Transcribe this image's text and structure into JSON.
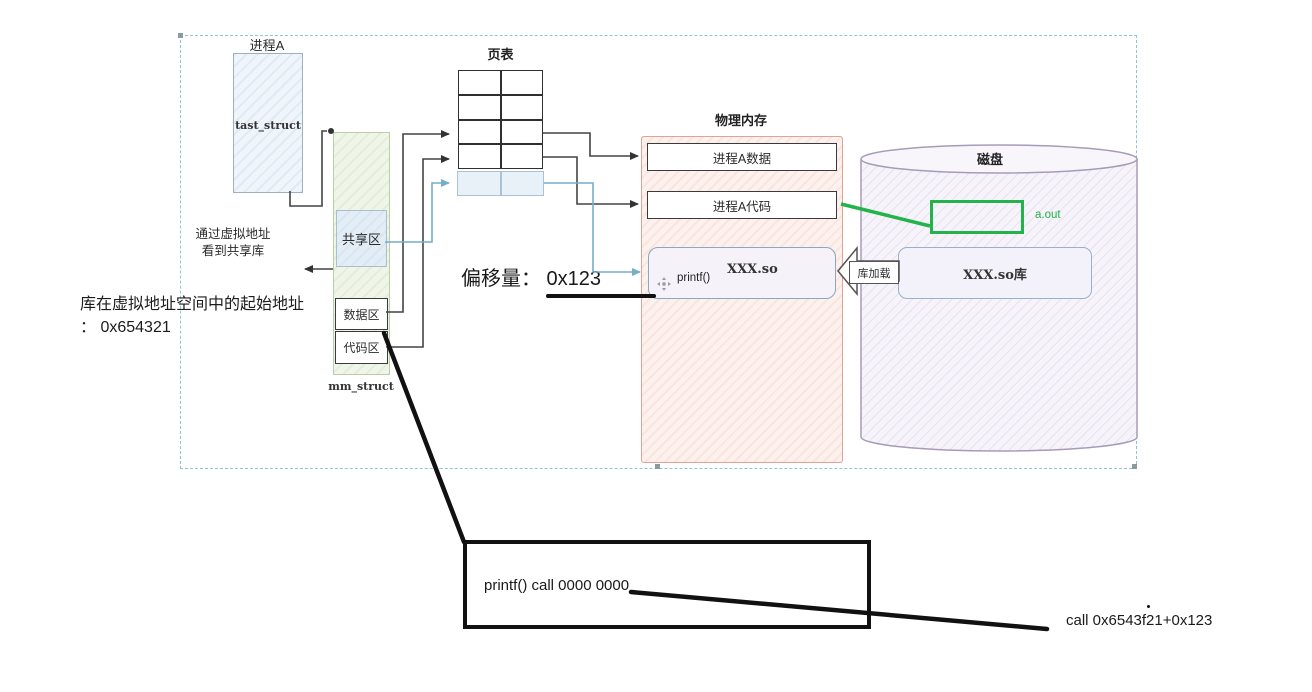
{
  "diagram": {
    "process_a": {
      "title": "进程A",
      "task_struct": "tast_struct"
    },
    "mm_struct": {
      "label": "mm_struct",
      "shared_region": "共享区",
      "data_region": "数据区",
      "code_region": "代码区"
    },
    "page_table": {
      "title": "页表"
    },
    "physical_memory": {
      "title": "物理内存",
      "proc_a_data": "进程A数据",
      "proc_a_code": "进程A代码",
      "so_box": {
        "func": "printf()",
        "lib": "XXX.so"
      }
    },
    "disk": {
      "title": "磁盘",
      "aout": "a.out",
      "so_lib": "XXX.so库"
    },
    "load_label": "库加载",
    "notes": {
      "virtual_addr_note_1": "通过虚拟地址",
      "virtual_addr_note_2": "看到共享库",
      "lib_base_note_1": "库在虚拟地址空间中的起始地址",
      "lib_base_note_2": "： 0x654321",
      "offset_note": "偏移量： 0x123",
      "printf_call_note": "printf() call 0000 0000",
      "resolved_call_note": "call 0x6543f21+0x123"
    },
    "colors": {
      "green_accent": "#24b24a",
      "blue_line": "#74aec8",
      "selection_dash": "#8fc6cc"
    }
  }
}
